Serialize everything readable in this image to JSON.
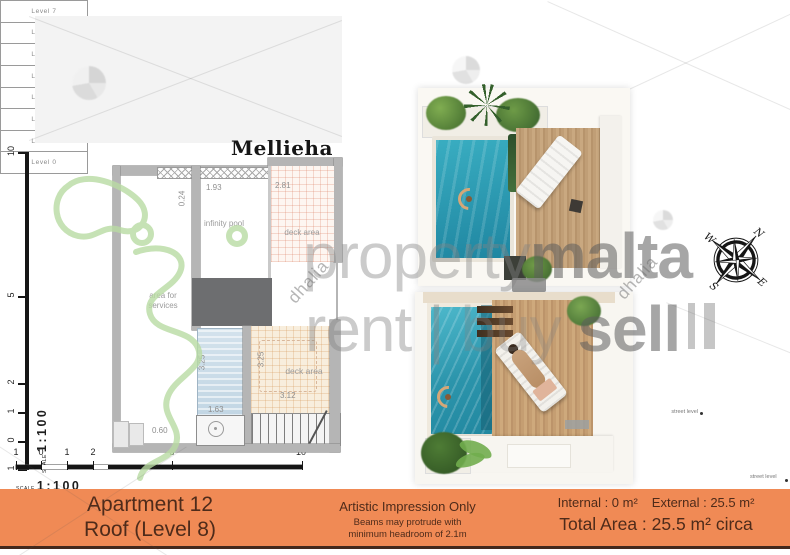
{
  "sheet": {
    "title": "Mellieha"
  },
  "watermark": {
    "brand_light": "property",
    "brand_bold": "malta",
    "tag_rent": "rent",
    "tag_sep": "|",
    "tag_buy": "buy",
    "tag_sell": "sell",
    "diagonal": "dhalia"
  },
  "colors": {
    "accent_orange": "#f08a55",
    "footer_text": "#4e2b1a",
    "render_pool_water": "#2e9fb8",
    "plan_pool_fill": "#cfe0ea",
    "watermark_green": "#b9dba3",
    "wall_gray": "#b5b5b5"
  },
  "floor_plan": {
    "rooms": {
      "infinity_pool": "infinity pool",
      "deck_area_upper": "deck area",
      "area_for_services": "area for services",
      "deck_area_lower": "deck area"
    },
    "dimensions": {
      "top_left": "1.93",
      "top_right": "2.81",
      "wall_left": "0.24",
      "pool_side": "3.25",
      "deck_side": "3.25",
      "deck_width": "3.12",
      "pool_width": "1.63",
      "bottom_left": "0.60"
    }
  },
  "scale": {
    "label": "SCALE",
    "ratio": "1:100",
    "horizontal_ticks": [
      "1",
      "0",
      "1",
      "2",
      "5",
      "10"
    ],
    "vertical_ticks": [
      "10",
      "5",
      "2",
      "1",
      "0",
      "1"
    ]
  },
  "compass": {
    "north": "N",
    "east": "E",
    "south": "S",
    "west": "W"
  },
  "levels": {
    "rows": [
      "Level 7",
      "Level 6",
      "Level 5",
      "Level 4",
      "Level 3",
      "Level 2",
      "Level 1",
      "Level 0"
    ],
    "street_left": "street level",
    "street_right": "street level"
  },
  "footer": {
    "apartment": "Apartment 12",
    "floor": "Roof (Level 8)",
    "disclaimer_title": "Artistic Impression Only",
    "disclaimer_line2": "Beams may protrude with",
    "disclaimer_line3": "minimum headroom of 2.1m",
    "internal": "Internal : 0 m²",
    "external": "External : 25.5 m²",
    "total": "Total Area : 25.5 m² circa"
  }
}
